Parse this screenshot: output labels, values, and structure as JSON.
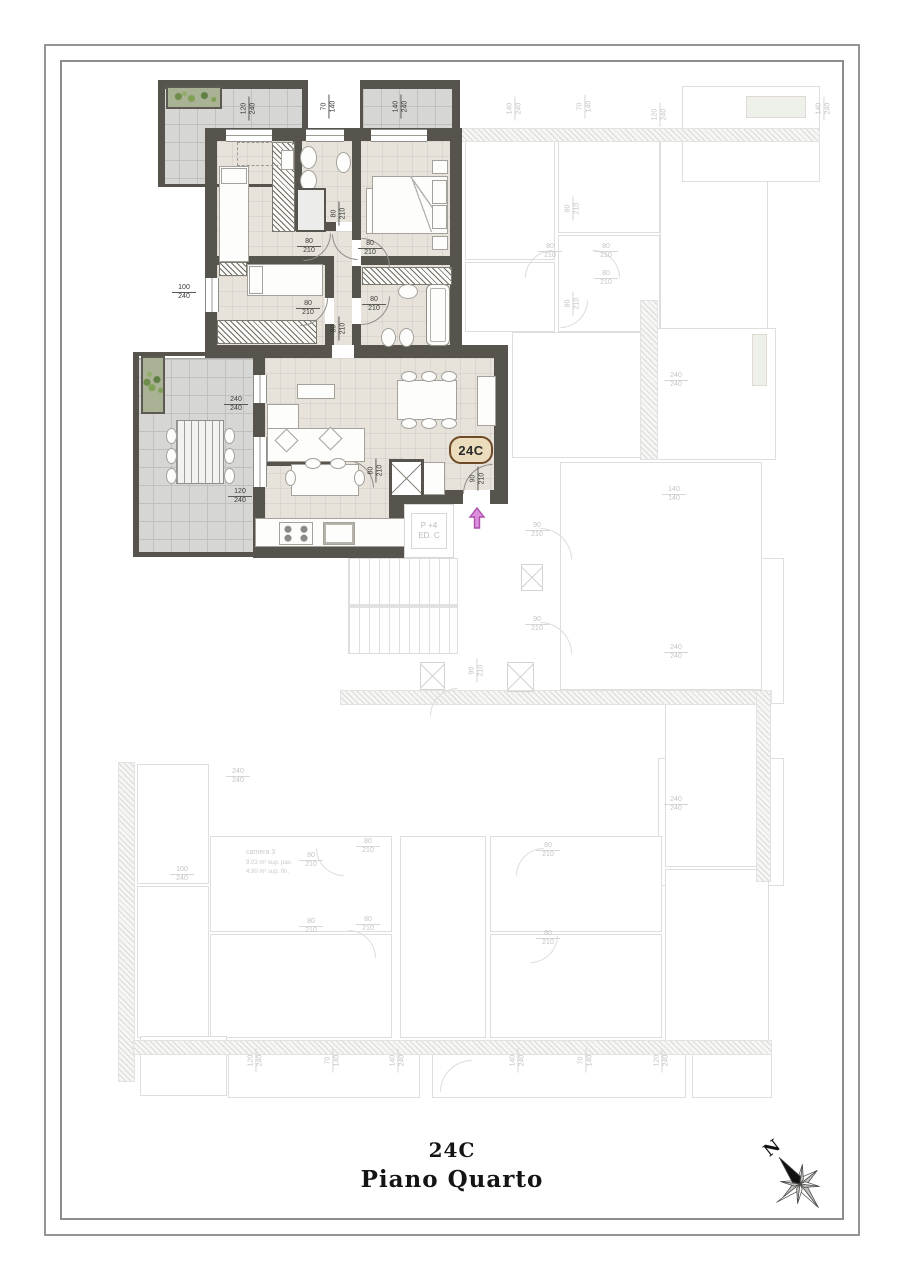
{
  "title_block": {
    "unit": "24C",
    "floor": "Piano Quarto"
  },
  "badge": {
    "label": "24C"
  },
  "compass": {
    "label": "N"
  },
  "stair_block": {
    "line1": "P +4",
    "line2": "ED. C"
  },
  "camera3": {
    "title": "camera 3",
    "line1": "9.03 m²  sup. pav.",
    "line2": "4.90 m²  sup. fin."
  },
  "colors": {
    "wall": "#57544e",
    "floor": "#e7e3db",
    "terrace": "#d6d6d4",
    "badge_fill": "#ecdcbe",
    "badge_border": "#6e4a26",
    "arrow_fill": "#dc8fdc",
    "arrow_stroke": "#ad4fad"
  },
  "dim_labels_main": [
    {
      "a": "120",
      "b": "240",
      "x": 237,
      "y": 100,
      "rot": true
    },
    {
      "a": "70",
      "b": "140",
      "x": 317,
      "y": 98,
      "rot": true
    },
    {
      "a": "140",
      "b": "240",
      "x": 389,
      "y": 98,
      "rot": true
    },
    {
      "a": "100",
      "b": "240",
      "x": 172,
      "y": 284,
      "rot": false
    },
    {
      "a": "80",
      "b": "210",
      "x": 297,
      "y": 238,
      "rot": false
    },
    {
      "a": "80",
      "b": "210",
      "x": 327,
      "y": 205,
      "rot": true
    },
    {
      "a": "80",
      "b": "210",
      "x": 358,
      "y": 240,
      "rot": false
    },
    {
      "a": "80",
      "b": "210",
      "x": 296,
      "y": 300,
      "rot": false
    },
    {
      "a": "80",
      "b": "210",
      "x": 327,
      "y": 320,
      "rot": true
    },
    {
      "a": "80",
      "b": "210",
      "x": 362,
      "y": 296,
      "rot": false
    },
    {
      "a": "240",
      "b": "240",
      "x": 224,
      "y": 396,
      "rot": false
    },
    {
      "a": "120",
      "b": "240",
      "x": 228,
      "y": 488,
      "rot": false
    },
    {
      "a": "80",
      "b": "210",
      "x": 364,
      "y": 462,
      "rot": true
    },
    {
      "a": "90",
      "b": "210",
      "x": 466,
      "y": 470,
      "rot": true
    }
  ],
  "dim_labels_faded": [
    {
      "a": "140",
      "b": "240",
      "x": 503,
      "y": 100,
      "rot": true
    },
    {
      "a": "70",
      "b": "140",
      "x": 573,
      "y": 98,
      "rot": true
    },
    {
      "a": "120",
      "b": "240",
      "x": 648,
      "y": 106,
      "rot": true
    },
    {
      "a": "140",
      "b": "240",
      "x": 812,
      "y": 100,
      "rot": true
    },
    {
      "a": "80",
      "b": "210",
      "x": 538,
      "y": 243,
      "rot": false
    },
    {
      "a": "80",
      "b": "210",
      "x": 594,
      "y": 243,
      "rot": false
    },
    {
      "a": "80",
      "b": "210",
      "x": 561,
      "y": 200,
      "rot": true
    },
    {
      "a": "80",
      "b": "210",
      "x": 594,
      "y": 270,
      "rot": false
    },
    {
      "a": "80",
      "b": "210",
      "x": 561,
      "y": 295,
      "rot": true
    },
    {
      "a": "240",
      "b": "240",
      "x": 664,
      "y": 372,
      "rot": false
    },
    {
      "a": "140",
      "b": "140",
      "x": 662,
      "y": 486,
      "rot": false
    },
    {
      "a": "90",
      "b": "210",
      "x": 525,
      "y": 522,
      "rot": false
    },
    {
      "a": "90",
      "b": "210",
      "x": 525,
      "y": 616,
      "rot": false
    },
    {
      "a": "90",
      "b": "210",
      "x": 465,
      "y": 662,
      "rot": true
    },
    {
      "a": "240",
      "b": "240",
      "x": 664,
      "y": 644,
      "rot": false
    },
    {
      "a": "240",
      "b": "240",
      "x": 664,
      "y": 796,
      "rot": false
    },
    {
      "a": "240",
      "b": "240",
      "x": 226,
      "y": 768,
      "rot": false
    },
    {
      "a": "100",
      "b": "240",
      "x": 170,
      "y": 866,
      "rot": false
    },
    {
      "a": "80",
      "b": "210",
      "x": 299,
      "y": 852,
      "rot": false
    },
    {
      "a": "80",
      "b": "210",
      "x": 356,
      "y": 838,
      "rot": false
    },
    {
      "a": "80",
      "b": "210",
      "x": 356,
      "y": 916,
      "rot": false
    },
    {
      "a": "80",
      "b": "210",
      "x": 299,
      "y": 918,
      "rot": false
    },
    {
      "a": "80",
      "b": "210",
      "x": 536,
      "y": 842,
      "rot": false
    },
    {
      "a": "80",
      "b": "210",
      "x": 536,
      "y": 930,
      "rot": false
    },
    {
      "a": "120",
      "b": "240",
      "x": 244,
      "y": 1052,
      "rot": true
    },
    {
      "a": "70",
      "b": "140",
      "x": 321,
      "y": 1052,
      "rot": true
    },
    {
      "a": "140",
      "b": "240",
      "x": 386,
      "y": 1052,
      "rot": true
    },
    {
      "a": "140",
      "b": "240",
      "x": 506,
      "y": 1052,
      "rot": true
    },
    {
      "a": "70",
      "b": "140",
      "x": 574,
      "y": 1052,
      "rot": true
    },
    {
      "a": "120",
      "b": "240",
      "x": 650,
      "y": 1052,
      "rot": true
    }
  ]
}
